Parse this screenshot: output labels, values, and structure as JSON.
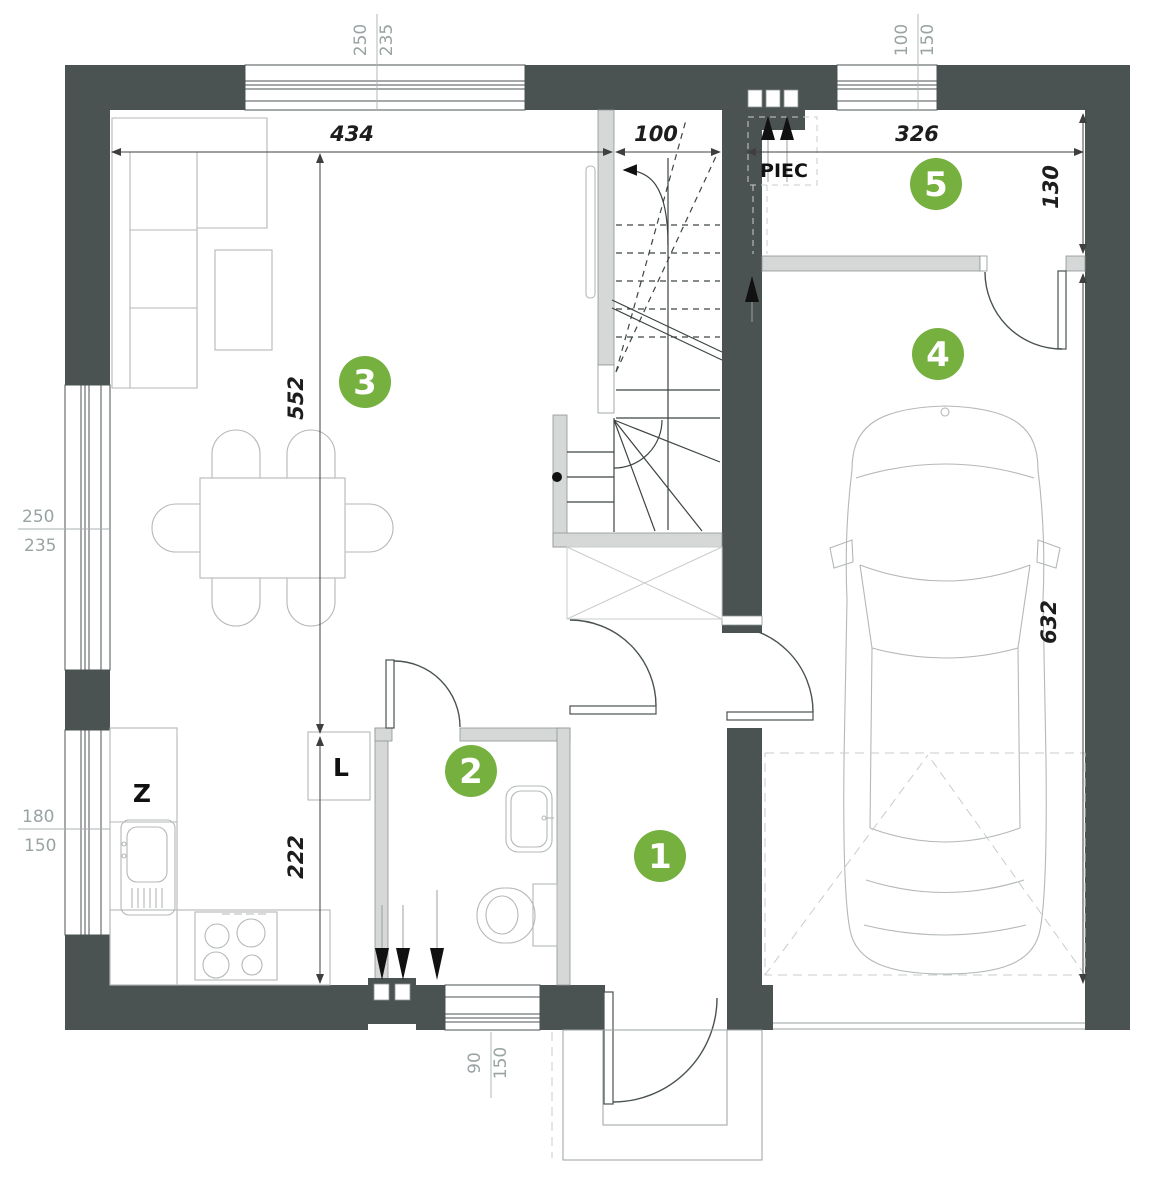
{
  "rooms": [
    {
      "number": "1"
    },
    {
      "number": "2"
    },
    {
      "number": "3"
    },
    {
      "number": "4"
    },
    {
      "number": "5"
    }
  ],
  "labels": {
    "furnace": "PIEC",
    "sink_cabinet": "Z",
    "tall_cabinet": "L"
  },
  "dimensions": {
    "living_width": "434",
    "stair_width": "100",
    "room5_width": "326",
    "room5_right_height": "130",
    "living_height": "552",
    "kitchen_height": "222",
    "garage_height": "632",
    "window_top": {
      "w": "250",
      "h": "235"
    },
    "window_top_right": {
      "w": "100",
      "h": "150"
    },
    "window_left_upper": {
      "w": "250",
      "h": "235"
    },
    "window_left_lower": {
      "w": "180",
      "h": "150"
    },
    "window_bottom": {
      "w": "90",
      "h": "150"
    }
  },
  "colors": {
    "wall": "#4a5252",
    "partition": "#d6d8d8",
    "accent_green": "#76b13f",
    "furniture_line": "#b4b8b8",
    "dim_text": "#1d1d1d",
    "window_dim_text": "#9aa3a3"
  }
}
